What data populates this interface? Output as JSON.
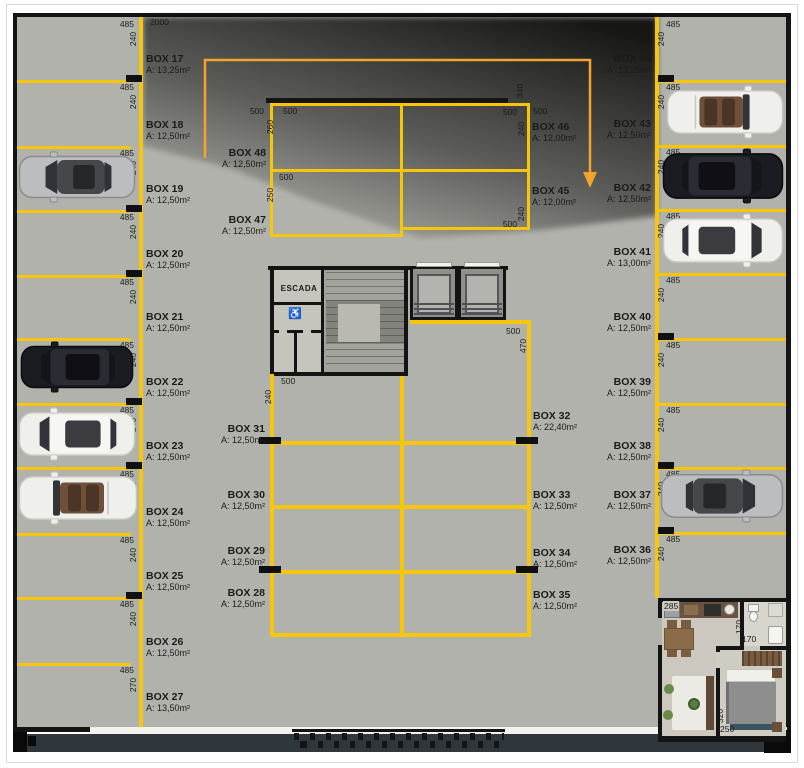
{
  "title": "parking-garage-floor-plan",
  "stairs": {
    "label": "ESCADA",
    "access_icon": "wheelchair-icon"
  },
  "boxes": {
    "left": [
      {
        "name": "BOX 17",
        "area": "A: 13,25m²"
      },
      {
        "name": "BOX 18",
        "area": "A: 12,50m²"
      },
      {
        "name": "BOX 19",
        "area": "A: 12,50m²"
      },
      {
        "name": "BOX 20",
        "area": "A: 12,50m²"
      },
      {
        "name": "BOX 21",
        "area": "A: 12,50m²"
      },
      {
        "name": "BOX 22",
        "area": "A: 12,50m²"
      },
      {
        "name": "BOX 23",
        "area": "A: 12,50m²"
      },
      {
        "name": "BOX 24",
        "area": "A: 12,50m²"
      },
      {
        "name": "BOX 25",
        "area": "A: 12,50m²"
      },
      {
        "name": "BOX 26",
        "area": "A: 12,50m²"
      },
      {
        "name": "BOX 27",
        "area": "A: 13,50m²"
      }
    ],
    "right": [
      {
        "name": "BOX 44",
        "area": "A: 13,25m²"
      },
      {
        "name": "BOX 43",
        "area": "A: 12,50m²"
      },
      {
        "name": "BOX 42",
        "area": "A: 12,50m²"
      },
      {
        "name": "BOX 41",
        "area": "A: 13,00m²"
      },
      {
        "name": "BOX 40",
        "area": "A: 12,50m²"
      },
      {
        "name": "BOX 39",
        "area": "A: 12,50m²"
      },
      {
        "name": "BOX 38",
        "area": "A: 12,50m²"
      },
      {
        "name": "BOX 37",
        "area": "A: 12,50m²"
      },
      {
        "name": "BOX 36",
        "area": "A: 12,50m²"
      }
    ],
    "center_top_left": [
      {
        "name": "BOX 48",
        "area": "A: 12,50m²"
      },
      {
        "name": "BOX 47",
        "area": "A: 12,50m²"
      }
    ],
    "center_top_right": [
      {
        "name": "BOX 46",
        "area": "A: 12,00m²"
      },
      {
        "name": "BOX 45",
        "area": "A: 12,00m²"
      }
    ],
    "grid_left": [
      {
        "name": "BOX 31",
        "area": "A: 12,50m²"
      },
      {
        "name": "BOX 30",
        "area": "A: 12,50m²"
      },
      {
        "name": "BOX 29",
        "area": "A: 12,50m²"
      },
      {
        "name": "BOX 28",
        "area": "A: 12,50m²"
      }
    ],
    "grid_right": [
      {
        "name": "BOX 32",
        "area": "A: 22,40m²"
      },
      {
        "name": "BOX 33",
        "area": "A: 12,50m²"
      },
      {
        "name": "BOX 34",
        "area": "A: 12,50m²"
      },
      {
        "name": "BOX 35",
        "area": "A: 12,50m²"
      }
    ]
  },
  "dims": {
    "overall_top": "2000",
    "left_pairs": [
      {
        "w": "485",
        "d": "240"
      },
      {
        "w": "485",
        "d": "240"
      },
      {
        "w": "485",
        "d": "240"
      },
      {
        "w": "485",
        "d": "240"
      },
      {
        "w": "485",
        "d": "240"
      },
      {
        "w": "485",
        "d": "240"
      },
      {
        "w": "485",
        "d": "240"
      },
      {
        "w": "485",
        "d": "240"
      },
      {
        "w": "485",
        "d": "240"
      },
      {
        "w": "485",
        "d": "240"
      },
      {
        "w": "485",
        "d": "270"
      }
    ],
    "right_pairs": [
      {
        "w": "485",
        "d": "240"
      },
      {
        "w": "485",
        "d": "240"
      },
      {
        "w": "485",
        "d": "240"
      },
      {
        "w": "485",
        "d": "240"
      },
      {
        "w": "485",
        "d": "240"
      },
      {
        "w": "485",
        "d": "240"
      },
      {
        "w": "485",
        "d": "240"
      },
      {
        "w": "485",
        "d": "240"
      },
      {
        "w": "485",
        "d": "240"
      }
    ],
    "center_top": {
      "left_out": "500",
      "left_out_depth": "260",
      "top_left": "500",
      "top_right": "500",
      "top_right_depth": "240",
      "right_out": "500",
      "corner_depth": "340",
      "mid_left": "500",
      "mid_left_depth": "250",
      "bottom_right": "500",
      "bottom_right_depth": "240"
    },
    "grid": {
      "left": "500",
      "left_depth": "240",
      "right": "500",
      "right_depth": "470"
    },
    "apartment": {
      "kitchen": "285",
      "bath_door_depth": "170",
      "bath_door": "170",
      "bedroom_depth": "320",
      "bedroom": "250"
    }
  },
  "cars": [
    {
      "box": "BOX 19",
      "style": "sedan",
      "color": "silver"
    },
    {
      "box": "BOX 22",
      "style": "suv",
      "color": "black"
    },
    {
      "box": "BOX 23",
      "style": "suv",
      "color": "white"
    },
    {
      "box": "BOX 24",
      "style": "convertible",
      "color": "white"
    },
    {
      "box": "BOX 43",
      "style": "convertible",
      "color": "white"
    },
    {
      "box": "BOX 42",
      "style": "suv",
      "color": "black"
    },
    {
      "box": "BOX 41",
      "style": "suv",
      "color": "white"
    },
    {
      "box": "BOX 37",
      "style": "sedan",
      "color": "silver"
    }
  ],
  "colors": {
    "floor": "#b2b2ac",
    "stall_line": "#f5c60a",
    "wall": "#141414",
    "arrow": "#f2a52d",
    "shadow": "#0d0d0d",
    "bottom_band": "#30373c"
  }
}
